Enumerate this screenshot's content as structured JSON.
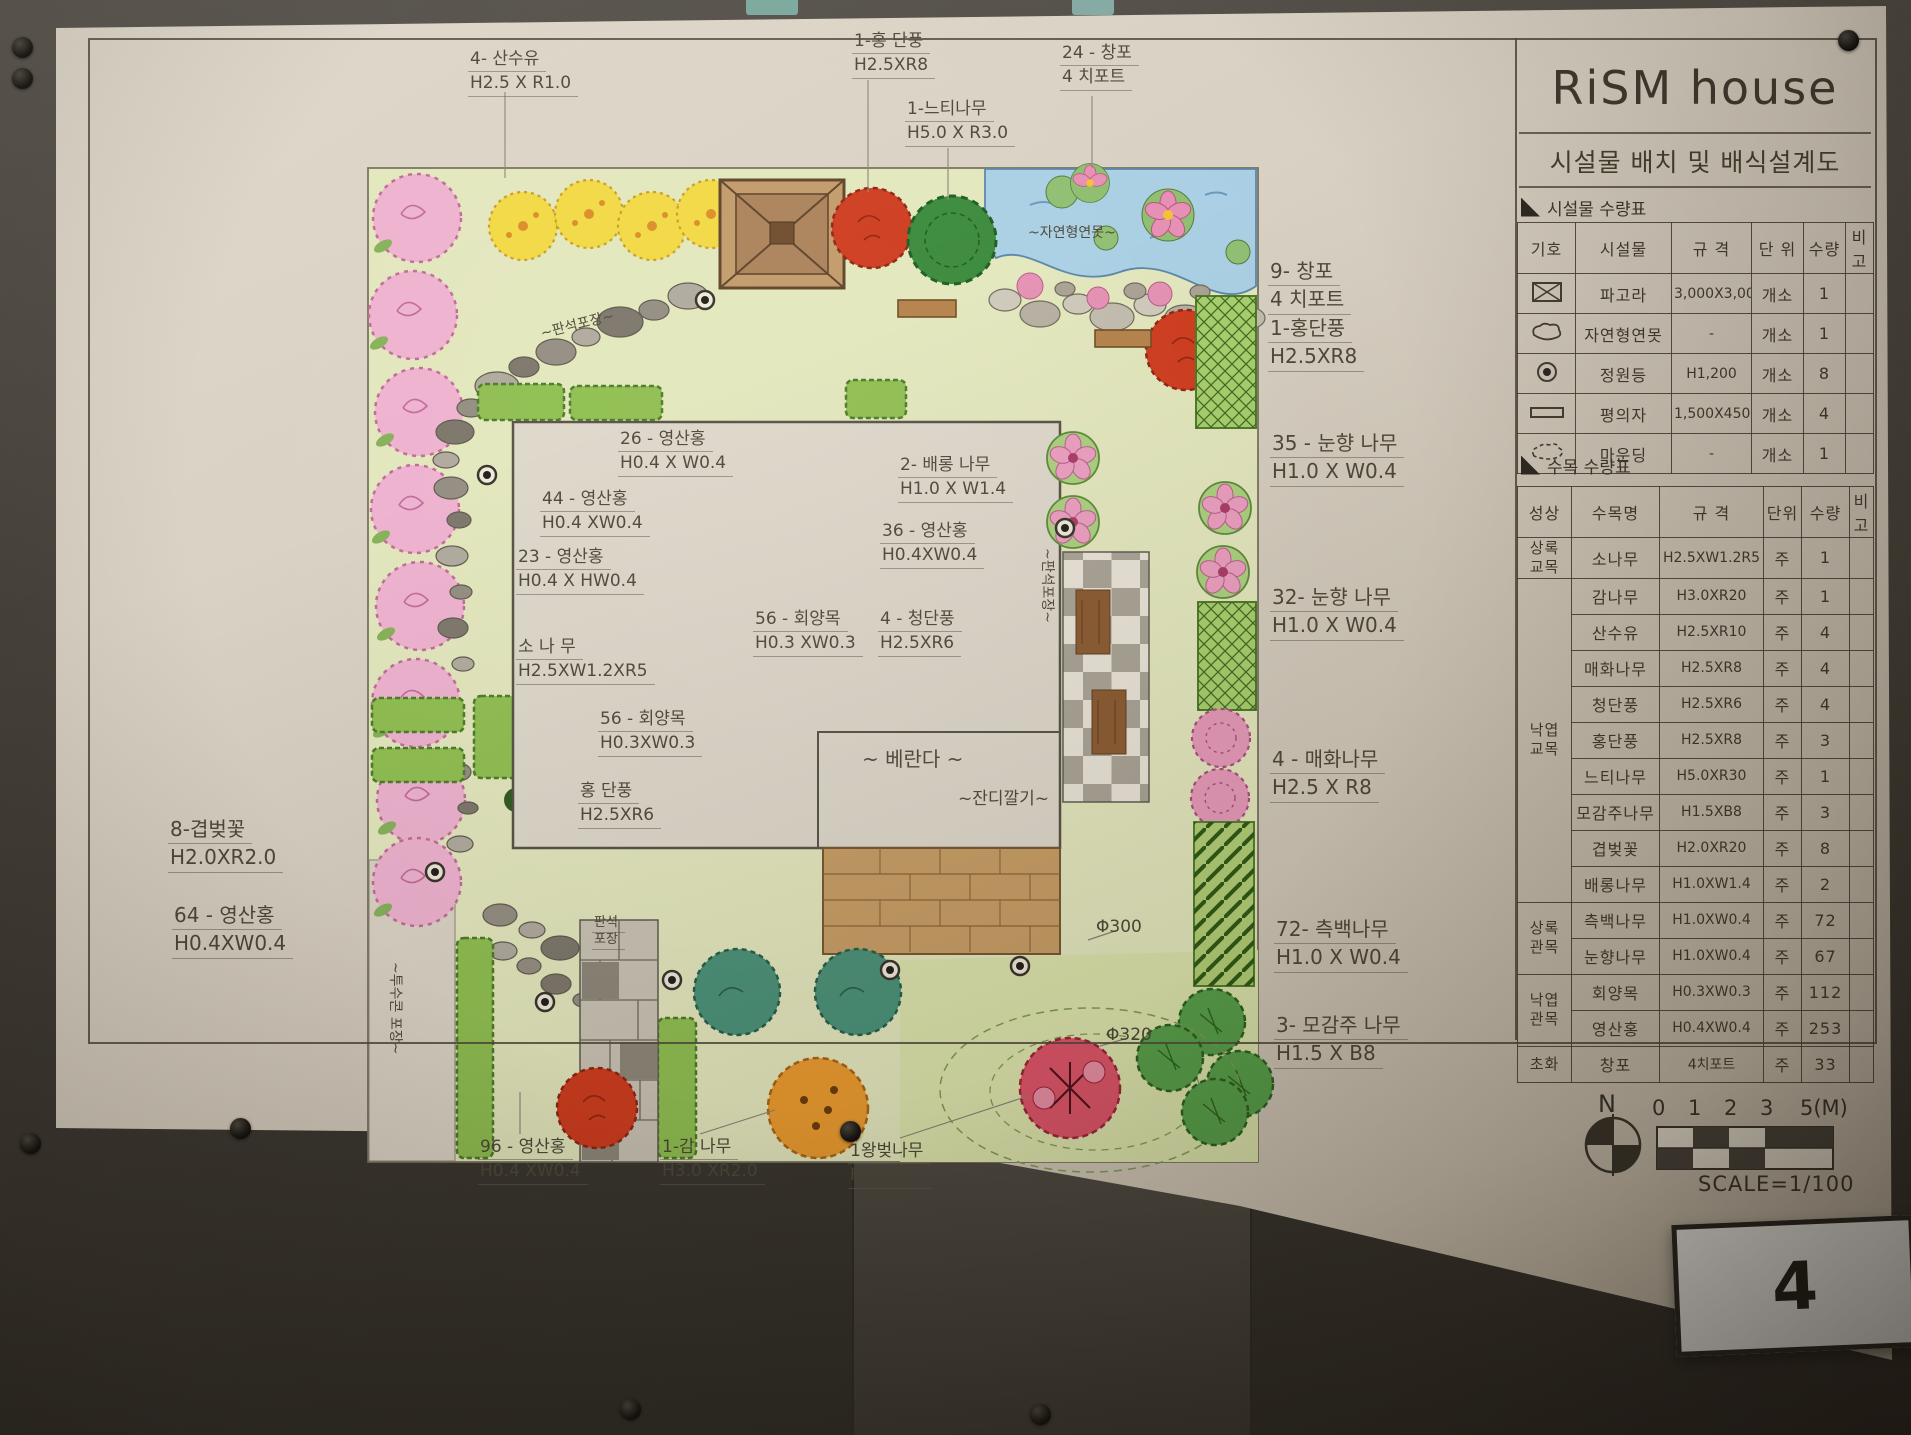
{
  "scene": {
    "page_number": "4"
  },
  "title_block": {
    "title": "RiSM house",
    "subtitle": "시설물 배치 및 배식설계도",
    "facility_table": {
      "caption": "시설물 수량표",
      "headers": [
        "기호",
        "시설물",
        "규 격",
        "단 위",
        "수량",
        "비고"
      ],
      "rows": [
        {
          "symbol": "pergola-icon",
          "name": "파고라",
          "spec": "3,000X3,000",
          "unit": "개소",
          "qty": "1",
          "note": ""
        },
        {
          "symbol": "pond-icon",
          "name": "자연형연못",
          "spec": "-",
          "unit": "개소",
          "qty": "1",
          "note": ""
        },
        {
          "symbol": "garden-light-icon",
          "name": "정원등",
          "spec": "H1,200",
          "unit": "개소",
          "qty": "8",
          "note": ""
        },
        {
          "symbol": "bench-icon",
          "name": "평의자",
          "spec": "1,500X450",
          "unit": "개소",
          "qty": "4",
          "note": ""
        },
        {
          "symbol": "mounding-icon",
          "name": "마운딩",
          "spec": "-",
          "unit": "개소",
          "qty": "1",
          "note": ""
        }
      ]
    },
    "tree_table": {
      "caption": "수목 수량표",
      "headers": [
        "성상",
        "수목명",
        "규 격",
        "단위",
        "수량",
        "비고"
      ],
      "groups": [
        {
          "label": "상록\n교목",
          "span": 1
        },
        {
          "label": "낙엽\n교목",
          "span": 9
        },
        {
          "label": "상록\n관목",
          "span": 2
        },
        {
          "label": "낙엽\n관목",
          "span": 2
        },
        {
          "label": "초화",
          "span": 1
        }
      ],
      "rows": [
        {
          "name": "소나무",
          "spec": "H2.5XW1.2R5",
          "unit": "주",
          "qty": "1",
          "note": ""
        },
        {
          "name": "감나무",
          "spec": "H3.0XR20",
          "unit": "주",
          "qty": "1",
          "note": ""
        },
        {
          "name": "산수유",
          "spec": "H2.5XR10",
          "unit": "주",
          "qty": "4",
          "note": ""
        },
        {
          "name": "매화나무",
          "spec": "H2.5XR8",
          "unit": "주",
          "qty": "4",
          "note": ""
        },
        {
          "name": "청단풍",
          "spec": "H2.5XR6",
          "unit": "주",
          "qty": "4",
          "note": ""
        },
        {
          "name": "홍단풍",
          "spec": "H2.5XR8",
          "unit": "주",
          "qty": "3",
          "note": ""
        },
        {
          "name": "느티나무",
          "spec": "H5.0XR30",
          "unit": "주",
          "qty": "1",
          "note": ""
        },
        {
          "name": "모감주나무",
          "spec": "H1.5XB8",
          "unit": "주",
          "qty": "3",
          "note": ""
        },
        {
          "name": "겹벚꽃",
          "spec": "H2.0XR20",
          "unit": "주",
          "qty": "8",
          "note": ""
        },
        {
          "name": "배롱나무",
          "spec": "H1.0XW1.4",
          "unit": "주",
          "qty": "2",
          "note": ""
        },
        {
          "name": "측백나무",
          "spec": "H1.0XW0.4",
          "unit": "주",
          "qty": "72",
          "note": ""
        },
        {
          "name": "눈향나무",
          "spec": "H1.0XW0.4",
          "unit": "주",
          "qty": "67",
          "note": ""
        },
        {
          "name": "회양목",
          "spec": "H0.3XW0.3",
          "unit": "주",
          "qty": "112",
          "note": ""
        },
        {
          "name": "영산홍",
          "spec": "H0.4XW0.4",
          "unit": "주",
          "qty": "253",
          "note": ""
        },
        {
          "name": "창포",
          "spec": "4치포트",
          "unit": "주",
          "qty": "33",
          "note": ""
        }
      ]
    },
    "north_label": "N",
    "scale_ticks": [
      "0",
      "1",
      "2",
      "3",
      "5(M)"
    ],
    "scale_text": "SCALE=1/100"
  },
  "plan": {
    "labels": [
      {
        "id": "label-sansuyu-top",
        "lines": [
          "4- 산수유",
          "H2.5 X R1.0"
        ],
        "x": 468,
        "y": 48,
        "style": ""
      },
      {
        "id": "label-hongdanpung-top",
        "lines": [
          "1-홍 단풍",
          "H2.5XR8"
        ],
        "x": 852,
        "y": 30,
        "style": ""
      },
      {
        "id": "label-neutinamu-top",
        "lines": [
          "1-느티나무",
          "H5.0 X R3.0"
        ],
        "x": 905,
        "y": 98,
        "style": ""
      },
      {
        "id": "label-changpo-top",
        "lines": [
          "24 - 창포",
          "4 치포트"
        ],
        "x": 1060,
        "y": 42,
        "style": ""
      },
      {
        "id": "label-changpo-right",
        "lines": [
          "9- 창포",
          "4 치포트",
          "1-홍단풍",
          "H2.5XR8"
        ],
        "x": 1268,
        "y": 258,
        "style": "big"
      },
      {
        "id": "label-nunhyang-35",
        "lines": [
          "35 - 눈향 나무",
          "H1.0 X W0.4"
        ],
        "x": 1270,
        "y": 430,
        "style": "big"
      },
      {
        "id": "label-nunhyang-32",
        "lines": [
          "32- 눈향 나무",
          "H1.0 X W0.4"
        ],
        "x": 1270,
        "y": 584,
        "style": "big"
      },
      {
        "id": "label-maehwa-right",
        "lines": [
          "4 - 매화나무",
          "H2.5 X R8"
        ],
        "x": 1270,
        "y": 746,
        "style": "big"
      },
      {
        "id": "label-cheukbaek-right",
        "lines": [
          "72- 측백나무",
          "H1.0 X W0.4"
        ],
        "x": 1274,
        "y": 916,
        "style": "big"
      },
      {
        "id": "label-mogamju-right",
        "lines": [
          "3- 모감주 나무",
          "H1.5 X B8"
        ],
        "x": 1274,
        "y": 1012,
        "style": "big"
      },
      {
        "id": "label-gyeopbeot-left",
        "lines": [
          "8-겹벚꽃",
          "H2.0XR2.0"
        ],
        "x": 168,
        "y": 816,
        "style": "big"
      },
      {
        "id": "label-yeongsan-64",
        "lines": [
          "64 - 영산홍",
          "H0.4XW0.4"
        ],
        "x": 172,
        "y": 902,
        "style": "big"
      },
      {
        "id": "label-yeongsan-96",
        "lines": [
          "96 - 영산홍",
          "H0.4 XW0.4"
        ],
        "x": 478,
        "y": 1136,
        "style": ""
      },
      {
        "id": "label-gamnamu-bottom",
        "lines": [
          "1-감 나무",
          "H3.0 XR2.0"
        ],
        "x": 660,
        "y": 1136,
        "style": ""
      },
      {
        "id": "label-wangbeot-bottom",
        "lines": [
          "1왕벚나무",
          "H3.5XB5"
        ],
        "x": 848,
        "y": 1140,
        "style": ""
      },
      {
        "id": "label-yeongsan-26",
        "lines": [
          "26 - 영산홍",
          "H0.4 X W0.4"
        ],
        "x": 618,
        "y": 428,
        "style": ""
      },
      {
        "id": "label-yeongsan-44",
        "lines": [
          "44 - 영산홍",
          "H0.4 XW0.4"
        ],
        "x": 540,
        "y": 488,
        "style": ""
      },
      {
        "id": "label-yeongsan-23",
        "lines": [
          "23 - 영산홍",
          "H0.4 X HW0.4"
        ],
        "x": 516,
        "y": 546,
        "style": ""
      },
      {
        "id": "label-baerong",
        "lines": [
          "2- 배롱 나무",
          "H1.0 X W1.4"
        ],
        "x": 898,
        "y": 454,
        "style": ""
      },
      {
        "id": "label-yeongsan-36",
        "lines": [
          "36 - 영산홍",
          "H0.4XW0.4"
        ],
        "x": 880,
        "y": 520,
        "style": ""
      },
      {
        "id": "label-hoeyang-56a",
        "lines": [
          "56 - 회양목",
          "H0.3 XW0.3"
        ],
        "x": 753,
        "y": 608,
        "style": ""
      },
      {
        "id": "label-cheongdanpung",
        "lines": [
          "4 - 청단풍",
          "H2.5XR6"
        ],
        "x": 878,
        "y": 608,
        "style": ""
      },
      {
        "id": "label-sonamu",
        "lines": [
          "소 나 무",
          "H2.5XW1.2XR5"
        ],
        "x": 516,
        "y": 636,
        "style": ""
      },
      {
        "id": "label-hoeyang-56b",
        "lines": [
          "56 - 회양목",
          "H0.3XW0.3"
        ],
        "x": 598,
        "y": 708,
        "style": ""
      },
      {
        "id": "label-hongdanpung-in",
        "lines": [
          "홍 단풍",
          "H2.5XR6"
        ],
        "x": 578,
        "y": 780,
        "style": ""
      },
      {
        "id": "label-veranda",
        "lines": [
          "~ 베란다 ~"
        ],
        "x": 862,
        "y": 746,
        "style": "plain big"
      },
      {
        "id": "label-pond",
        "lines": [
          "~자연형연못~"
        ],
        "x": 1028,
        "y": 224,
        "style": "plain small"
      },
      {
        "id": "label-lawn",
        "lines": [
          "~잔디깔기~"
        ],
        "x": 958,
        "y": 788,
        "style": "plain"
      },
      {
        "id": "label-phi300",
        "lines": [
          "Φ300"
        ],
        "x": 1096,
        "y": 916,
        "style": "plain"
      },
      {
        "id": "label-phi320",
        "lines": [
          "Φ320"
        ],
        "x": 1106,
        "y": 1024,
        "style": "plain"
      },
      {
        "id": "label-panseok-vert",
        "lines": [
          "~판석포장~"
        ],
        "x": 1056,
        "y": 548,
        "style": "plain small vert"
      },
      {
        "id": "label-panseok-block",
        "lines": [
          "판석",
          "포장"
        ],
        "x": 592,
        "y": 916,
        "style": "tiny"
      },
      {
        "id": "label-tusukon",
        "lines": [
          "~투수콘 포장~"
        ],
        "x": 404,
        "y": 962,
        "style": "plain small vert"
      },
      {
        "id": "label-panseok-path",
        "lines": [
          "~판석포장~"
        ],
        "x": 540,
        "y": 316,
        "style": "plain small tilt"
      }
    ]
  }
}
